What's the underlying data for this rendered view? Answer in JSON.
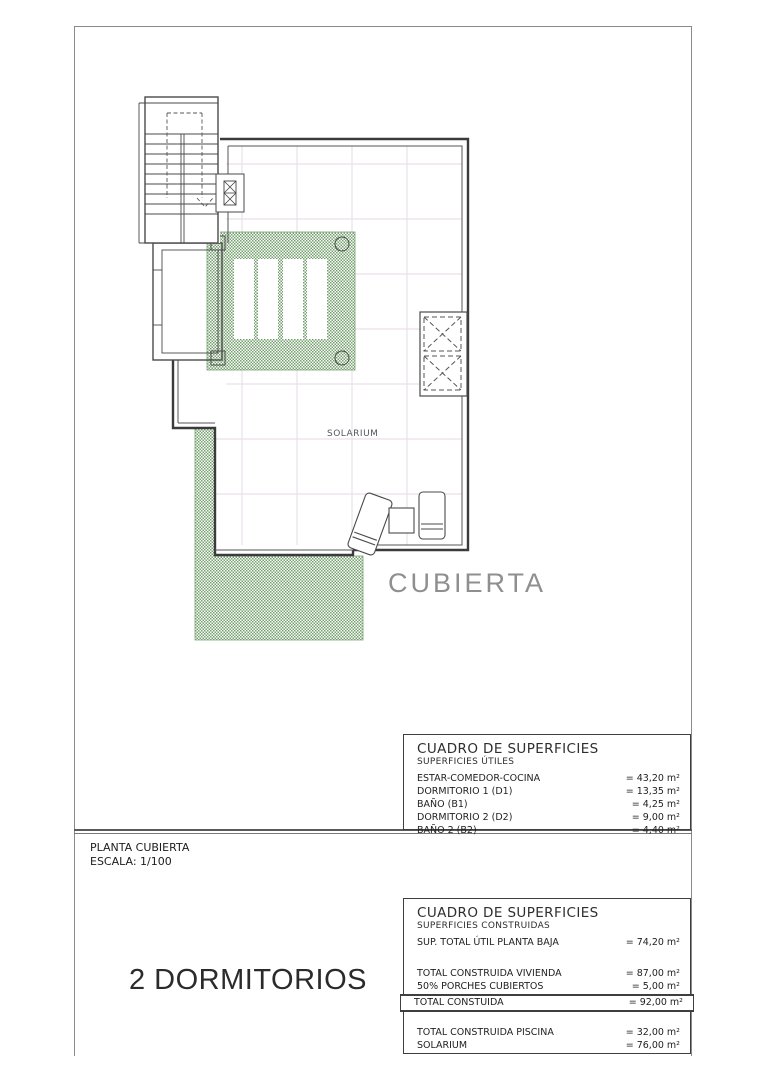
{
  "page": {
    "type_label": "2 DORMITORIOS",
    "title_block": {
      "plan_name": "PLANTA CUBIERTA",
      "scale": "ESCALA: 1/100"
    },
    "plan": {
      "solarium_label": "SOLARIUM",
      "roof_label": "CUBIERTA"
    },
    "tables": {
      "utiles": {
        "title": "CUADRO DE SUPERFICIES",
        "subtitle": "SUPERFICIES ÚTILES",
        "rows": [
          {
            "label": "ESTAR-COMEDOR-COCINA",
            "value": "= 43,20 m²"
          },
          {
            "label": "DORMITORIO 1 (D1)",
            "value": "= 13,35 m²"
          },
          {
            "label": "BAÑO  (B1)",
            "value": "= 4,25 m²"
          },
          {
            "label": "DORMITORIO 2 (D2)",
            "value": "= 9,00 m²"
          },
          {
            "label": "BAÑO 2 (B2)",
            "value": "= 4,40 m²"
          }
        ]
      },
      "construidas": {
        "title": "CUADRO DE SUPERFICIES",
        "subtitle": "SUPERFICIES CONSTRUIDAS",
        "row_sup": {
          "label": "SUP. TOTAL ÚTIL PLANTA BAJA",
          "value": "= 74,20 m²"
        },
        "rows_mid": [
          {
            "label": "TOTAL CONSTRUIDA VIVIENDA",
            "value": "= 87,00 m²"
          },
          {
            "label": "50% PORCHES CUBIERTOS",
            "value": "= 5,00 m²"
          }
        ],
        "row_total": {
          "label": "TOTAL CONSTUIDA",
          "value": "= 92,00 m²"
        },
        "rows_bottom": [
          {
            "label": "TOTAL CONSTRUIDA PISCINA",
            "value": "= 32,00 m²"
          },
          {
            "label": "SOLARIUM",
            "value": "= 76,00 m²"
          }
        ]
      }
    },
    "colors": {
      "pergola_green": "#74a06f",
      "grid_pink": "#e9e1e9",
      "line_dark": "#3b3b3b"
    }
  }
}
